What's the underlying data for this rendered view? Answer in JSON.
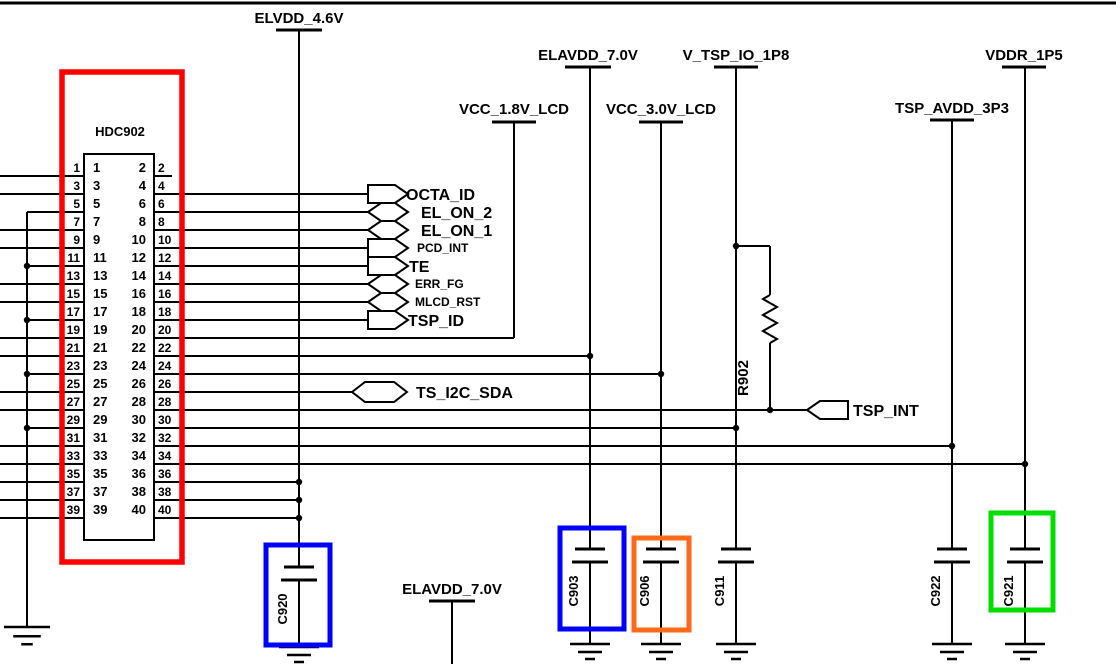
{
  "schematic": {
    "canvas": {
      "w": 1116,
      "h": 664,
      "bg": "#ffffff",
      "line_color": "#000000"
    },
    "top_border": [
      0,
      3,
      1116,
      3
    ],
    "connector": {
      "refdes": "HDC902",
      "refdes_pos": {
        "x": 120,
        "y": 136
      },
      "inner_box": {
        "x": 84,
        "y": 154,
        "w": 70,
        "h": 386
      },
      "row_start_y": 176,
      "row_spacing": 18,
      "rows": [
        [
          "1",
          "2"
        ],
        [
          "3",
          "4"
        ],
        [
          "5",
          "6"
        ],
        [
          "7",
          "8"
        ],
        [
          "9",
          "10"
        ],
        [
          "11",
          "12"
        ],
        [
          "13",
          "14"
        ],
        [
          "15",
          "16"
        ],
        [
          "17",
          "18"
        ],
        [
          "19",
          "20"
        ],
        [
          "21",
          "22"
        ],
        [
          "23",
          "24"
        ],
        [
          "25",
          "26"
        ],
        [
          "27",
          "28"
        ],
        [
          "29",
          "30"
        ],
        [
          "31",
          "32"
        ],
        [
          "33",
          "34"
        ],
        [
          "35",
          "36"
        ],
        [
          "37",
          "38"
        ],
        [
          "39",
          "40"
        ]
      ]
    },
    "wires": [
      [
        0,
        176,
        84,
        176
      ],
      [
        0,
        194,
        84,
        194
      ],
      [
        0,
        230,
        84,
        230
      ],
      [
        0,
        248,
        84,
        248
      ],
      [
        0,
        284,
        84,
        284
      ],
      [
        0,
        302,
        84,
        302
      ],
      [
        0,
        338,
        84,
        338
      ],
      [
        0,
        356,
        84,
        356
      ],
      [
        0,
        392,
        84,
        392
      ],
      [
        0,
        410,
        84,
        410
      ],
      [
        0,
        446,
        84,
        446
      ],
      [
        0,
        464,
        84,
        464
      ],
      [
        0,
        482,
        84,
        482
      ],
      [
        0,
        500,
        84,
        500
      ],
      [
        0,
        518,
        84,
        518
      ],
      [
        27,
        212,
        84,
        212
      ],
      [
        27,
        266,
        84,
        266
      ],
      [
        27,
        320,
        84,
        320
      ],
      [
        27,
        374,
        84,
        374
      ],
      [
        27,
        428,
        84,
        428
      ],
      [
        27,
        212,
        27,
        627
      ],
      [
        154,
        176,
        172,
        176
      ],
      [
        154,
        194,
        368,
        194
      ],
      [
        154,
        212,
        368,
        212
      ],
      [
        154,
        230,
        368,
        230
      ],
      [
        154,
        248,
        368,
        248
      ],
      [
        154,
        266,
        368,
        266
      ],
      [
        154,
        284,
        368,
        284
      ],
      [
        154,
        302,
        368,
        302
      ],
      [
        154,
        320,
        368,
        320
      ],
      [
        154,
        338,
        514,
        338
      ],
      [
        154,
        356,
        590,
        356
      ],
      [
        154,
        374,
        661,
        374
      ],
      [
        154,
        392,
        352,
        392
      ],
      [
        154,
        410,
        807,
        410
      ],
      [
        154,
        428,
        736,
        428
      ],
      [
        154,
        446,
        952,
        446
      ],
      [
        154,
        464,
        1025,
        464
      ],
      [
        154,
        482,
        299,
        482
      ],
      [
        154,
        500,
        299,
        500
      ],
      [
        154,
        518,
        299,
        518
      ],
      [
        299,
        30,
        299,
        567
      ],
      [
        514,
        123,
        514,
        338
      ],
      [
        590,
        67,
        590,
        549
      ],
      [
        661,
        123,
        661,
        549
      ],
      [
        736,
        67,
        736,
        549
      ],
      [
        952,
        120,
        952,
        549
      ],
      [
        1025,
        67,
        1025,
        549
      ],
      [
        452,
        601,
        452,
        664
      ],
      [
        736,
        246,
        770,
        246
      ],
      [
        770,
        246,
        770,
        295
      ],
      [
        770,
        343,
        770,
        410
      ]
    ],
    "dots": [
      [
        27,
        266
      ],
      [
        27,
        320
      ],
      [
        27,
        374
      ],
      [
        27,
        428
      ],
      [
        299,
        482
      ],
      [
        299,
        500
      ],
      [
        299,
        518
      ],
      [
        590,
        356
      ],
      [
        661,
        374
      ],
      [
        736,
        246
      ],
      [
        736,
        428
      ],
      [
        770,
        410
      ],
      [
        952,
        446
      ],
      [
        1025,
        464
      ]
    ],
    "power_labels": [
      {
        "label": "ELVDD_4.6V",
        "x": 299,
        "text_y": 23,
        "bar_y": 30,
        "bar_w": 46
      },
      {
        "label": "ELAVDD_7.0V",
        "x": 588,
        "text_y": 60,
        "bar_y": 67,
        "bar_w": 46
      },
      {
        "label": "V_TSP_IO_1P8",
        "x": 736,
        "text_y": 60,
        "bar_y": 67,
        "bar_w": 44
      },
      {
        "label": "VDDR_1P5",
        "x": 1024,
        "text_y": 60,
        "bar_y": 67,
        "bar_w": 44
      },
      {
        "label": "VCC_1.8V_LCD",
        "x": 514,
        "text_y": 114,
        "bar_y": 122,
        "bar_w": 44
      },
      {
        "label": "VCC_3.0V_LCD",
        "x": 661,
        "text_y": 114,
        "bar_y": 122,
        "bar_w": 44
      },
      {
        "label": "TSP_AVDD_3P3",
        "x": 952,
        "text_y": 113,
        "bar_y": 120,
        "bar_w": 44
      },
      {
        "label": "ELAVDD_7.0V",
        "x": 452,
        "text_y": 594,
        "bar_y": 601,
        "bar_w": 46
      }
    ],
    "flags": [
      {
        "type": "out",
        "x": 368,
        "y": 194,
        "w": 40,
        "label": "OCTA_ID",
        "size": 16,
        "label_x": 406
      },
      {
        "type": "bidir",
        "x": 368,
        "y": 212,
        "w": 40,
        "label": "EL_ON_2",
        "size": 16,
        "label_x": 421
      },
      {
        "type": "bidir",
        "x": 368,
        "y": 230,
        "w": 40,
        "label": "EL_ON_1",
        "size": 16,
        "label_x": 421
      },
      {
        "type": "out",
        "x": 368,
        "y": 248,
        "w": 40,
        "label": "PCD_INT",
        "size": 12,
        "label_x": 417
      },
      {
        "type": "out",
        "x": 368,
        "y": 266,
        "w": 40,
        "label": "TE",
        "size": 16,
        "label_x": 409
      },
      {
        "type": "bidir",
        "x": 368,
        "y": 284,
        "w": 40,
        "label": "ERR_FG",
        "size": 12,
        "label_x": 415
      },
      {
        "type": "bidir",
        "x": 368,
        "y": 302,
        "w": 40,
        "label": "MLCD_RST",
        "size": 12,
        "label_x": 415
      },
      {
        "type": "out",
        "x": 368,
        "y": 320,
        "w": 40,
        "label": "TSP_ID",
        "size": 16,
        "label_x": 408
      },
      {
        "type": "bidir",
        "x": 352,
        "y": 392,
        "w": 55,
        "label": "TS_I2C_SDA",
        "size": 16,
        "label_x": 416
      },
      {
        "type": "in",
        "x": 807,
        "y": 410,
        "w": 41,
        "label": "TSP_INT",
        "size": 16,
        "label_x": 853
      }
    ],
    "resistor": {
      "refdes": "R902",
      "x": 770,
      "zig_top": 295,
      "zig_bottom": 343,
      "label_x": 748,
      "label_y": 378
    },
    "capacitors": [
      {
        "refdes": "C920",
        "x": 299,
        "plate_y": 567,
        "ground_y": 647
      },
      {
        "refdes": "C903",
        "x": 590,
        "plate_y": 549,
        "ground_y": 644
      },
      {
        "refdes": "C906",
        "x": 661,
        "plate_y": 549,
        "ground_y": 644
      },
      {
        "refdes": "C911",
        "x": 736,
        "plate_y": 549,
        "ground_y": 644
      },
      {
        "refdes": "C922",
        "x": 952,
        "plate_y": 549,
        "ground_y": 644
      },
      {
        "refdes": "C921",
        "x": 1025,
        "plate_y": 549,
        "ground_y": 644
      }
    ],
    "grounds": [
      [
        27,
        627,
        1.15
      ],
      [
        299,
        647,
        1
      ],
      [
        590,
        644,
        1
      ],
      [
        661,
        644,
        1
      ],
      [
        736,
        644,
        1
      ],
      [
        952,
        644,
        1
      ],
      [
        1025,
        644,
        1
      ]
    ],
    "highlight_boxes": [
      {
        "name": "connector-highlight-red",
        "x": 62,
        "y": 72,
        "w": 120,
        "h": 490,
        "color": "#ff0000",
        "sw": 5.5
      },
      {
        "name": "c920-highlight-blue",
        "x": 266,
        "y": 545,
        "w": 64,
        "h": 100,
        "color": "#0000ff",
        "sw": 5
      },
      {
        "name": "c903-highlight-blue",
        "x": 560,
        "y": 528,
        "w": 64,
        "h": 101,
        "color": "#0000ff",
        "sw": 5
      },
      {
        "name": "c906-highlight-orange",
        "x": 634,
        "y": 538,
        "w": 55,
        "h": 92,
        "color": "#ff6a1a",
        "sw": 5
      },
      {
        "name": "c921-highlight-green",
        "x": 991,
        "y": 513,
        "w": 62,
        "h": 97,
        "color": "#00dd00",
        "sw": 5
      }
    ]
  }
}
